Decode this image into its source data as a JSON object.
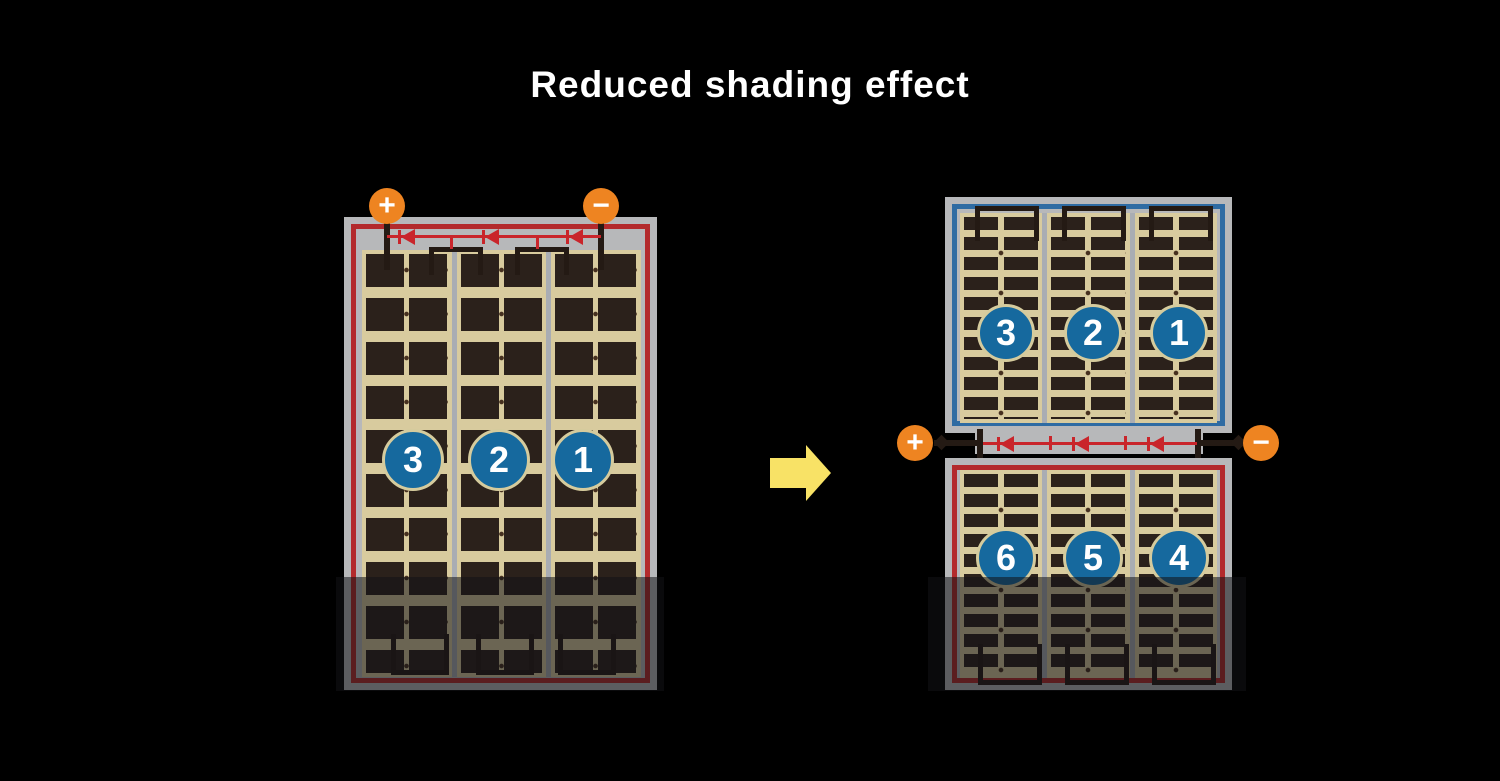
{
  "title": "Reduced shading effect",
  "left_panel": {
    "description": "full string panel with shading",
    "terminals": {
      "positive": "+",
      "negative": "−"
    },
    "section_numbers": [
      "3",
      "2",
      "1"
    ]
  },
  "right_assembly": {
    "description": "split half-cut panel pair with shading",
    "terminals": {
      "positive": "+",
      "negative": "−"
    },
    "top_panel_numbers": [
      "3",
      "2",
      "1"
    ],
    "bottom_panel_numbers": [
      "6",
      "5",
      "4"
    ]
  },
  "colors": {
    "background": "#000000",
    "title_text": "#ffffff",
    "panel_frame_gray": "#b7b8ba",
    "cell_dark": "#2b211b",
    "cell_tan": "#d8cb9e",
    "border_red": "#b32a2c",
    "border_blue": "#2e6ba3",
    "terminal_orange": "#ee8421",
    "number_circle_blue": "#16699e",
    "diode_red": "#c9252b",
    "arrow_yellow": "#f8e266",
    "shading_overlay": "rgba(18,18,22,0.55)"
  }
}
